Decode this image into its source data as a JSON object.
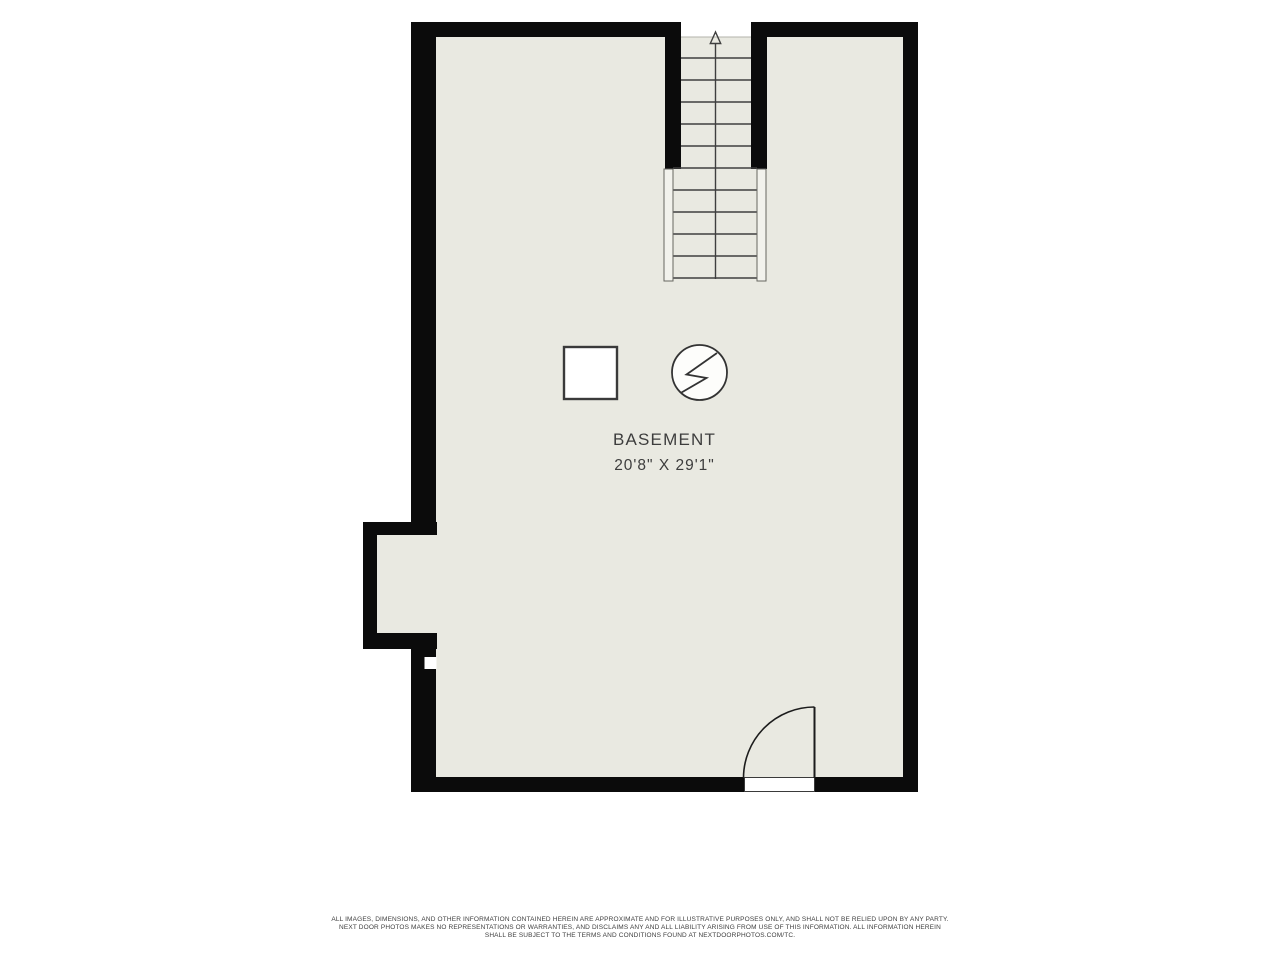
{
  "plan": {
    "room_label": "BASEMENT",
    "room_dimensions": "20'8\" X 29'1\"",
    "stair_direction": "up",
    "icons": {
      "square_symbol": "appliance-square-icon",
      "circle_symbol": "lightning-circle-icon",
      "arrow": "stair-up-arrow-icon"
    },
    "colors": {
      "wall": "#0b0b0b",
      "floor": "#e9e9e1",
      "line": "#3d3d3d",
      "rail_fill": "#f2f2ec",
      "background": "#ffffff"
    }
  },
  "footer": {
    "lines": [
      "ALL IMAGES, DIMENSIONS, AND OTHER INFORMATION CONTAINED HEREIN ARE APPROXIMATE AND FOR ILLUSTRATIVE PURPOSES ONLY, AND SHALL NOT BE RELIED UPON BY ANY PARTY.",
      "NEXT DOOR PHOTOS MAKES NO REPRESENTATIONS OR WARRANTIES, AND DISCLAIMS ANY AND ALL LIABILITY ARISING FROM USE OF THIS INFORMATION. ALL INFORMATION HEREIN",
      "SHALL BE SUBJECT TO THE TERMS AND CONDITIONS FOUND AT NEXTDOORPHOTOS.COM/TC."
    ]
  }
}
